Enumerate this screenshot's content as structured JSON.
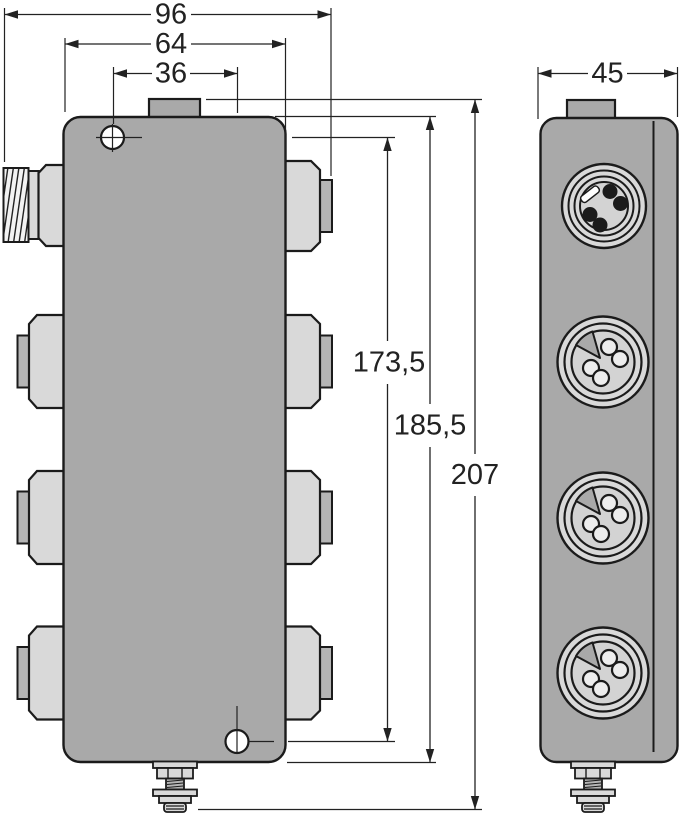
{
  "drawing": {
    "kind": "technical dimension drawing",
    "description": "Two orthographic views of a multi-port junction box with round M12 connector faces, two mounting holes, a top tab and a grounding bolt",
    "dimensions": {
      "overall_width": "96",
      "housing_width": "64",
      "mounting_hole_offset_x": "36",
      "side_width": "45",
      "mounting_hole_spacing": "173,5",
      "housing_length": "185,5",
      "overall_length": "207"
    },
    "views": {
      "front": {
        "name": "front view",
        "left_ports": [
          "threaded-coupling",
          "flange-port",
          "flange-port",
          "flange-port"
        ],
        "right_ports": [
          "flange-port",
          "flange-port",
          "flange-port",
          "flange-port"
        ],
        "mounting_holes": 2,
        "has_ground_terminal": true
      },
      "side": {
        "name": "side view",
        "round_connector_faces": 4,
        "has_ground_terminal": true
      }
    },
    "colors": {
      "background": "#ffffff",
      "housing": "#a9a9a9",
      "flange": "#d9d9d9",
      "collar": "#b5b5b5",
      "connector_face": "#d3d3d3",
      "socket_fill": "#ededed",
      "pin": "#1b1b1b",
      "outline": "#1b1b1b",
      "dimension_lines": "#222222"
    }
  }
}
